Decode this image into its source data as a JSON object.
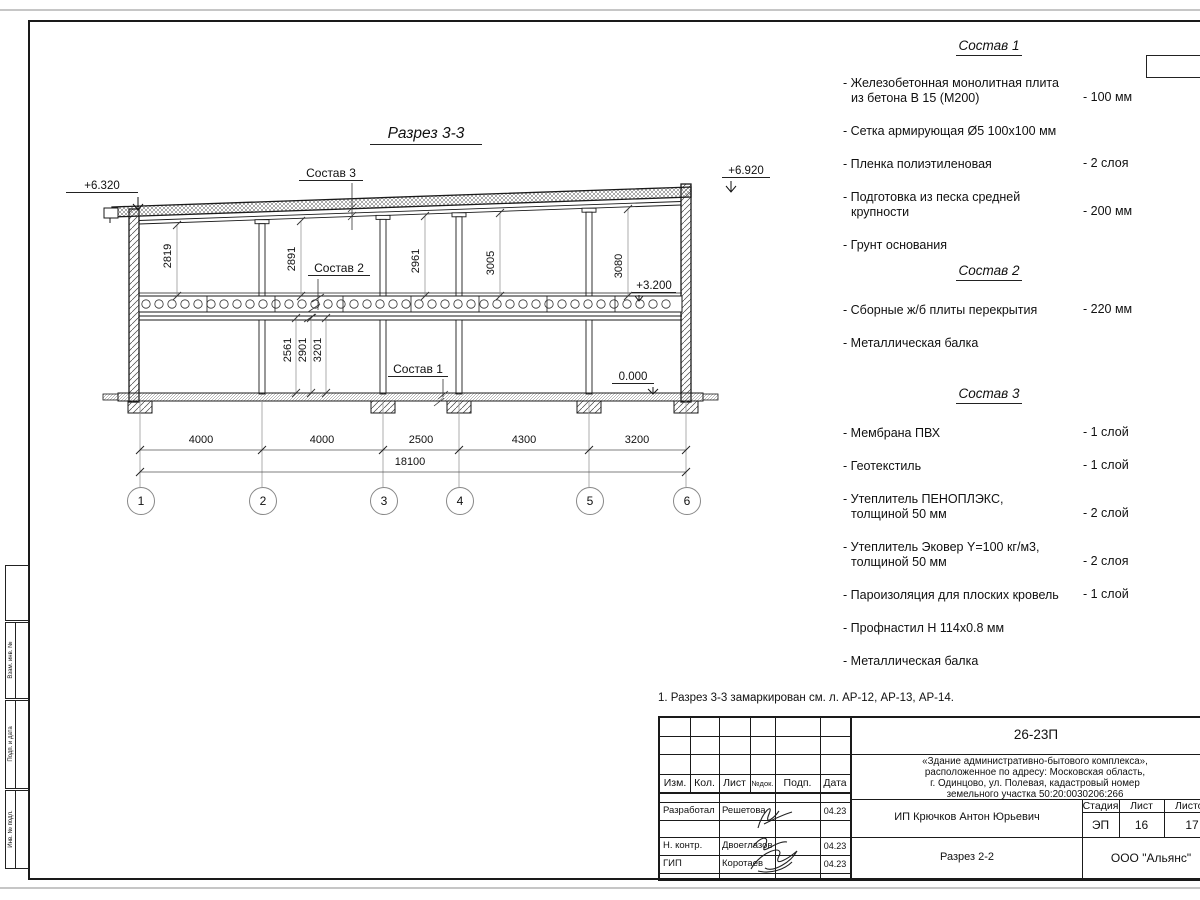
{
  "drawing": {
    "title": "Разрез 3-3",
    "marks": {
      "left": "+6.320",
      "right": "+6.920",
      "floor": "+3.200",
      "ground": "0.000"
    },
    "labels": {
      "s1": "Состав 1",
      "s2": "Состав 2",
      "s3": "Состав 3"
    },
    "upper_dims": [
      "2819",
      "2891",
      "2961",
      "3005",
      "3080"
    ],
    "lower_dims": [
      "2561",
      "2901",
      "3201"
    ],
    "span_dims": [
      "4000",
      "4000",
      "2500",
      "4300",
      "3200"
    ],
    "total_dim": "18100",
    "axes": [
      "1",
      "2",
      "3",
      "4",
      "5",
      "6"
    ]
  },
  "lists": {
    "s1": {
      "title": "Состав 1",
      "items": [
        {
          "l1": "- Железобетонная  монолитная плита",
          "l2": "из бетона В 15 (М200)",
          "v": "- 100 мм"
        },
        {
          "l1": "- Сетка армирующая Ø5 100x100 мм",
          "l2": "",
          "v": ""
        },
        {
          "l1": "- Пленка полиэтиленовая",
          "l2": "",
          "v": "-  2 слоя"
        },
        {
          "l1": "- Подготовка из песка средней",
          "l2": "крупности",
          "v": "- 200 мм"
        },
        {
          "l1": "- Грунт основания",
          "l2": "",
          "v": ""
        }
      ]
    },
    "s2": {
      "title": "Состав 2",
      "items": [
        {
          "l1": "- Сборные ж/б плиты перекрытия",
          "l2": "",
          "v": "- 220 мм"
        },
        {
          "l1": "- Металлическая балка",
          "l2": "",
          "v": ""
        }
      ]
    },
    "s3": {
      "title": "Состав 3",
      "items": [
        {
          "l1": "- Мембрана ПВХ",
          "l2": "",
          "v": "- 1 слой"
        },
        {
          "l1": "- Геотекстиль",
          "l2": "",
          "v": "- 1 слой"
        },
        {
          "l1": "- Утеплитель ПЕНОПЛЭКС,",
          "l2": "толщиной 50 мм",
          "v": "- 2 слой"
        },
        {
          "l1": "- Утеплитель Эковер Y=100 кг/м3,",
          "l2": "толщиной 50 мм",
          "v": "- 2 слоя"
        },
        {
          "l1": "- Пароизоляция для плоских кровель",
          "l2": "",
          "v": "- 1 слой"
        },
        {
          "l1": "- Профнастил Н 114x0.8 мм",
          "l2": "",
          "v": ""
        },
        {
          "l1": "- Металлическая балка",
          "l2": "",
          "v": ""
        }
      ]
    }
  },
  "note": "1. Разрез 3-3 замаркирован см. л. АР-12, АР-13, АР-14.",
  "titleblock": {
    "code": "26-23П",
    "object1": "«Здание административно-бытового комплекса»,",
    "object2": "расположенное по адресу: Московская область,",
    "object3": "г. Одинцово, ул. Полевая, кадастровый номер",
    "object4": "земельного участка 50:20:0030206:266",
    "cols": {
      "izm": "Изм.",
      "kol": "Кол.",
      "list": "Лист",
      "ndok": "№док.",
      "podp": "Подп.",
      "data": "Дата"
    },
    "stage_cols": {
      "stage": "Стадия",
      "sheet": "Лист",
      "sheets": "Листов"
    },
    "stage": "ЭП",
    "sheet": "16",
    "sheets": "17",
    "rows": [
      {
        "role": "Разработал",
        "name": "Решетова",
        "date": "04.23"
      },
      {
        "role": "Н. контр.",
        "name": "Двоеглазов",
        "date": "04.23"
      },
      {
        "role": "ГИП",
        "name": "Коротаев",
        "date": "04.23"
      }
    ],
    "customer": "ИП Крючков Антон Юрьевич",
    "sheet_name": "Разрез 2-2",
    "org": "ООО \"Альянс\""
  },
  "side_stamp": [
    "Взам. инв. №",
    "Подп. и дата",
    "Инв. № подл."
  ]
}
